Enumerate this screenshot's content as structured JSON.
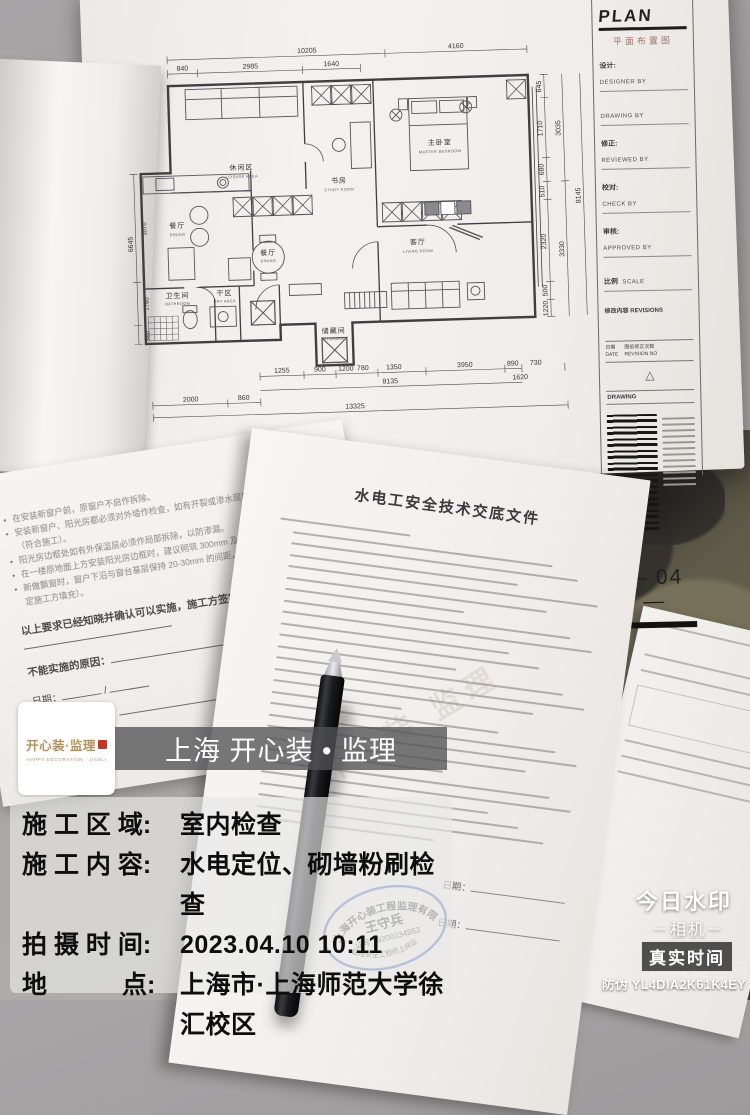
{
  "watermark": {
    "logo": {
      "brand": "开心装·监理",
      "brand_sub": "HAPPY DECORATION · JIANLI"
    },
    "title": "上海 开心装 • 监理",
    "rows": [
      {
        "label": "施 工 区 域: ",
        "value": "室内检查"
      },
      {
        "label": "施 工 内 容: ",
        "value": "水电定位、砌墙粉刷检查"
      },
      {
        "label": "拍 摄 时 间: ",
        "value": "2023.04.10 10:11"
      },
      {
        "label": "地　　　点: ",
        "value": "上海市·上海师范大学徐汇校区"
      }
    ]
  },
  "marks": {
    "app_name": "今日水印",
    "app_sub": "－相机－",
    "badge": "真实时间",
    "anti_fake": "防伪 YL4DIA2K61K4EY",
    "liba": "liba",
    "liba_com": ".com",
    "liba_cn": "篱笆网"
  },
  "blueprint": {
    "titleblock": {
      "plan": "PLAN",
      "plan_cn": "平面布置图",
      "designer_cn": "设计:",
      "designer_en": "DESIGNER BY",
      "drawing_en": "DRAWING BY",
      "reviewed_cn": "修正:",
      "reviewed_en": "REVIEWED BY",
      "check_cn": "校对:",
      "check_en": "CHECK BY",
      "approved_cn": "审核:",
      "approved_en": "APPROVED BY",
      "scale_cn": "比例",
      "scale_en": "SCALE",
      "revisions_cn": "修改内容",
      "revisions_en": "REVISIONS",
      "date_cn": "日期",
      "date_en": "DATE",
      "revno_cn": "图纸修正次数",
      "revno_en": "REVISION NO",
      "drawing_label": "DRAWING",
      "page_no": "— 04 —"
    },
    "plan": {
      "rooms": {
        "leisure_cn": "休闲区",
        "leisure_en": "LEISURE AREA",
        "study_cn": "书房",
        "study_en": "STUDY ROOM",
        "master_cn": "主卧室",
        "master_en": "MASTER BEDROOM",
        "dining1_cn": "餐厅",
        "dining1_en": "DINING",
        "dining2_cn": "餐厅",
        "dining2_en": "DINING",
        "living_cn": "客厅",
        "living_en": "LIVING ROOM",
        "bath_cn": "卫生间",
        "bath_en": "BATHROOM",
        "dry_cn": "干区",
        "dry_en": "DRY AREA",
        "storage_cn": "储藏间",
        "storage_en": "STORAGE"
      },
      "dims": {
        "top": [
          "10205",
          "4160",
          "840",
          "2985",
          "1640"
        ],
        "left": [
          "6645",
          "3070",
          "1760",
          "560"
        ],
        "right": [
          "645",
          "1710",
          "680",
          "510",
          "2320",
          "500",
          "1220",
          "3035",
          "3330",
          "8145"
        ],
        "bottom": [
          "1255",
          "900",
          "1200",
          "780",
          "1350",
          "3950",
          "890",
          "730",
          "8135",
          "1620",
          "2000",
          "860",
          "13325"
        ]
      }
    }
  },
  "document": {
    "title": "水电工安全技术交底文件",
    "page_watermark": "开心装 监理",
    "date_label": "日期：",
    "stamp": {
      "company": "上海开心装工程监理有限公司",
      "name": "王守兵",
      "cert": "证号:19200234863",
      "bottom": "监理安全工程师上岗证"
    }
  },
  "booklet": {
    "bullets": [
      "在安装新窗户前，原窗户不启作拆除。",
      "安装新窗户、阳光房都必须对外墙作检查，如有开裂或渗水现象，必须先作修复处理（符合施工）。",
      "阳光房边框处如有外保温层必须作局部拆除，以防渗漏。",
      "在一楼原地面上方安装阳光房边框时，建议砌筑 300mm 及以上的红砖/混凝土基础。",
      "新做飘窗时，窗户下沿与窗台基层保持 20-30mm 的间距，需要用 1:3 水泥砂浆填实（确定施工方填充）。"
    ],
    "sign_line": "以上要求已经知晓并确认可以实施，施工方签字：",
    "reason_line": "不能实施的原因：",
    "date_label": "日期：",
    "date_sep": "/",
    "confirm_line": "客户知晓并确认："
  }
}
